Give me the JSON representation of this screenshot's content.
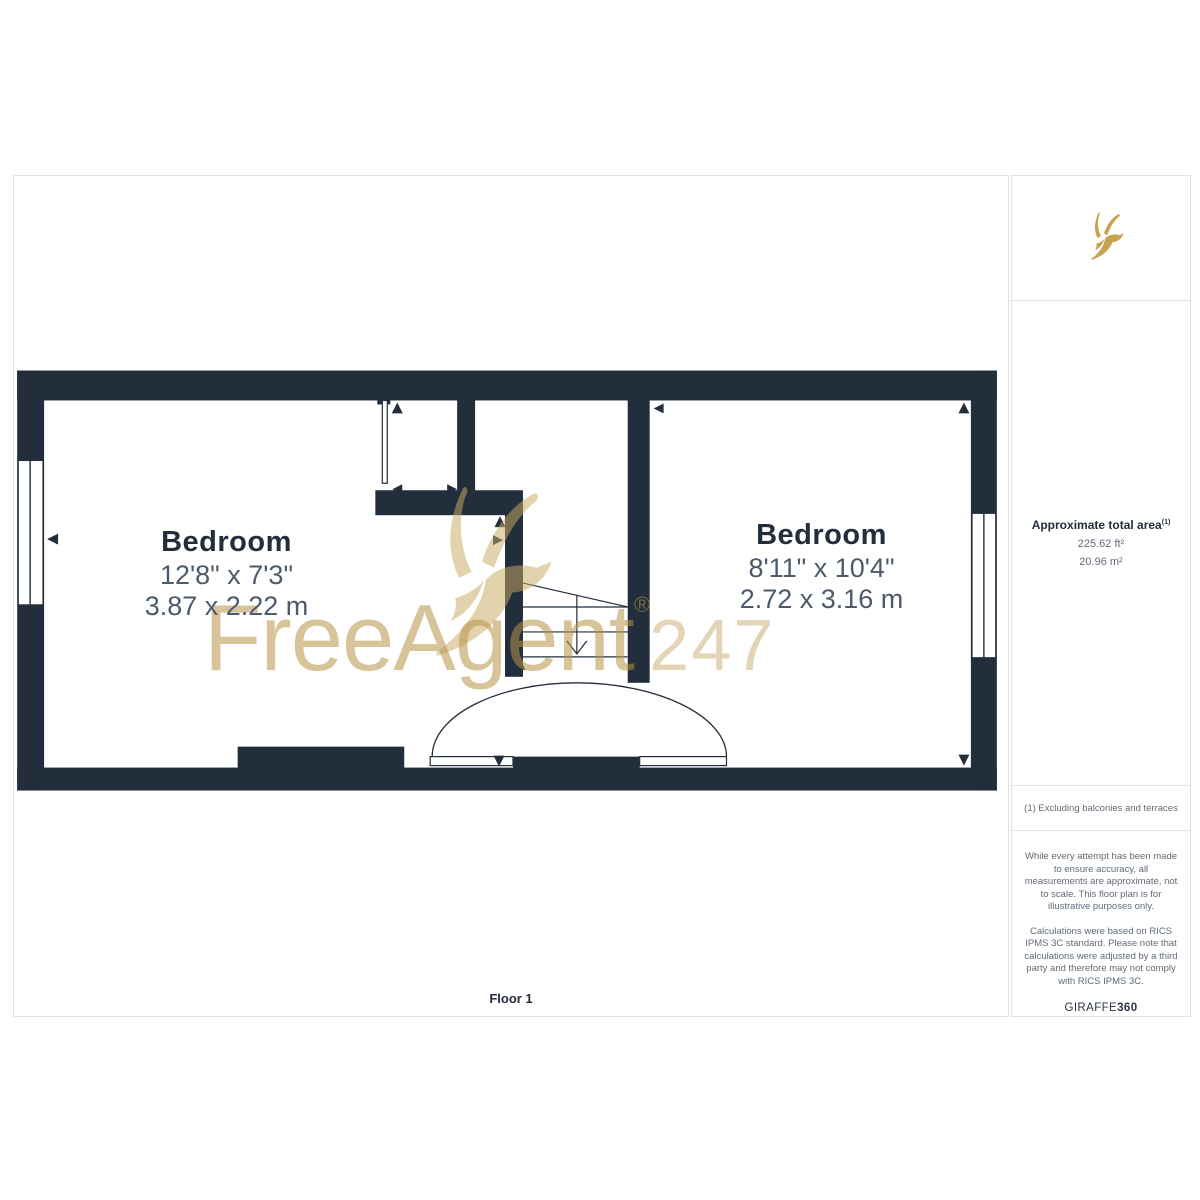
{
  "plan": {
    "floor_label": "Floor 1",
    "rooms": [
      {
        "name": "Bedroom",
        "imperial": "12'8\" x 7'3\"",
        "metric": "3.87 x 2.22 m"
      },
      {
        "name": "Bedroom",
        "imperial": "8'11\" x 10'4\"",
        "metric": "2.72 x 3.16 m"
      }
    ],
    "watermark": {
      "brand": "FreeAgent",
      "registered": "®",
      "suffix": "247"
    }
  },
  "sidebar": {
    "area": {
      "title": "Approximate total area",
      "footnote_marker": "(1)",
      "imperial": "225.62 ft²",
      "metric": "20.96 m²"
    },
    "footnote": "(1) Excluding balconies and terraces",
    "disclaimer_1": "While every attempt has been made to ensure accuracy, all measurements are approximate, not to scale. This floor plan is for illustrative purposes only.",
    "disclaimer_2": "Calculations were based on RICS IPMS 3C standard. Please note that calculations were adjusted by a third party and therefore may not comply with RICS IPMS 3C.",
    "brand": {
      "name": "GIRAFFE",
      "suffix": "360"
    }
  },
  "colors": {
    "wall": "#222e3c",
    "dim_text": "#4d5a6b",
    "gold": "#c8a24e",
    "watermark_gold": "rgba(182,148,70,0.55)",
    "border": "#e2e2e2",
    "muted_text": "#606b78"
  }
}
